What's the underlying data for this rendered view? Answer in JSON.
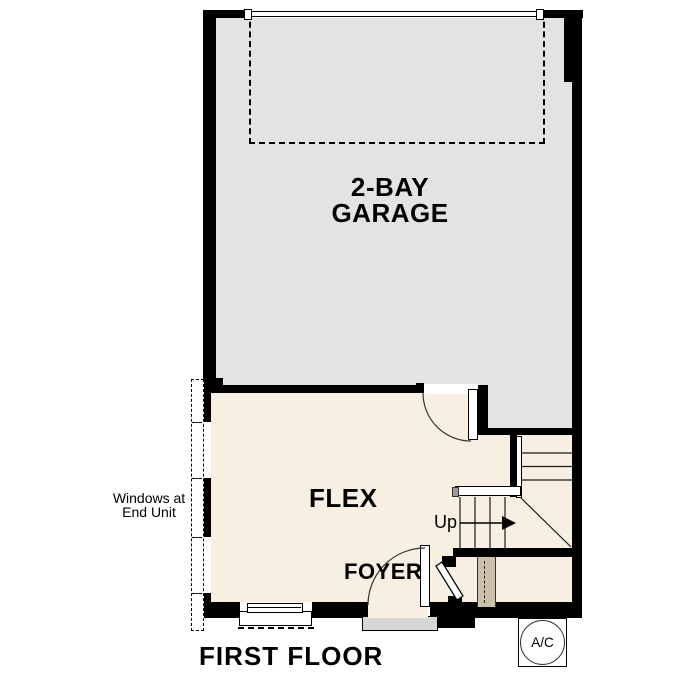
{
  "floor_plan": {
    "title": "FIRST FLOOR",
    "rooms": {
      "garage_line1": "2-BAY",
      "garage_line2": "GARAGE",
      "flex": "FLEX",
      "foyer": "FOYER"
    },
    "stairs": {
      "up_label": "Up"
    },
    "notes": {
      "windows_line1": "Windows at",
      "windows_line2": "End Unit"
    },
    "equipment": {
      "ac_label": "A/C"
    },
    "colors": {
      "wall": "#000000",
      "garage_fill": "#e3e3e3",
      "room_fill": "#f7efe1",
      "stair_soffit_fill": "#ccc1a9",
      "stoop_fill": "#d6d6d6"
    }
  }
}
